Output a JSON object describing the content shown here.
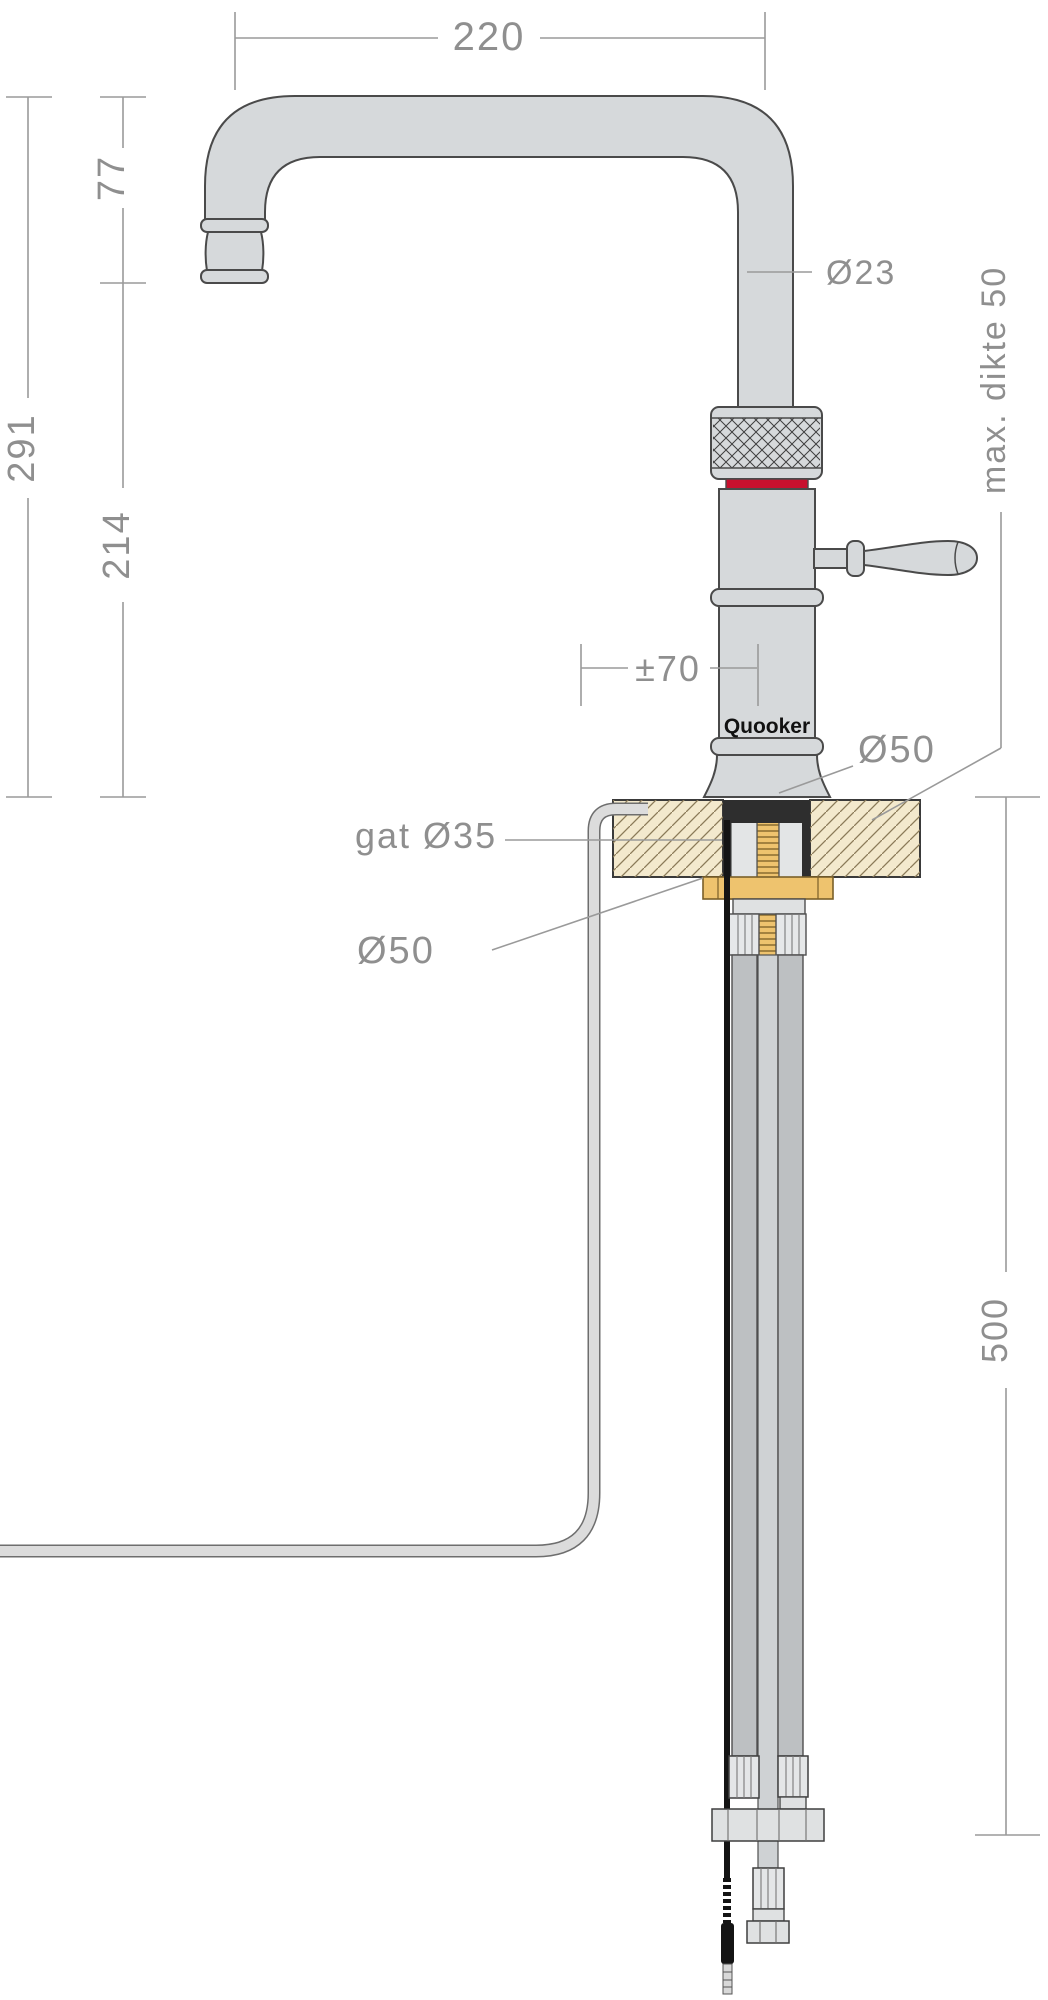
{
  "drawing": {
    "title": "Quooker tap technical dimension drawing",
    "labels": {
      "dim_spout_reach": "220",
      "dim_spout_drop": "77",
      "dim_total_height": "291",
      "dim_outlet_height": "214",
      "dia_spout": "Ø23",
      "max_thickness": "max. dikte 50",
      "dim_swivel": "±70",
      "brand": "Quooker",
      "dia_base_top": "Ø50",
      "hole_dia": "gat Ø35",
      "dia_escutcheon_bottom": "Ø50",
      "dim_below_worktop": "500"
    },
    "colors": {
      "accent_red": "#c8102e",
      "brass": "#eec36e",
      "worktop_tan": "#f3e9cd",
      "steel_fill": "#d6d9db",
      "outline": "#4a4a4a",
      "dim_gray": "#9a9a9a",
      "text_gray": "#8f8f8f",
      "cable_black": "#141414"
    }
  }
}
